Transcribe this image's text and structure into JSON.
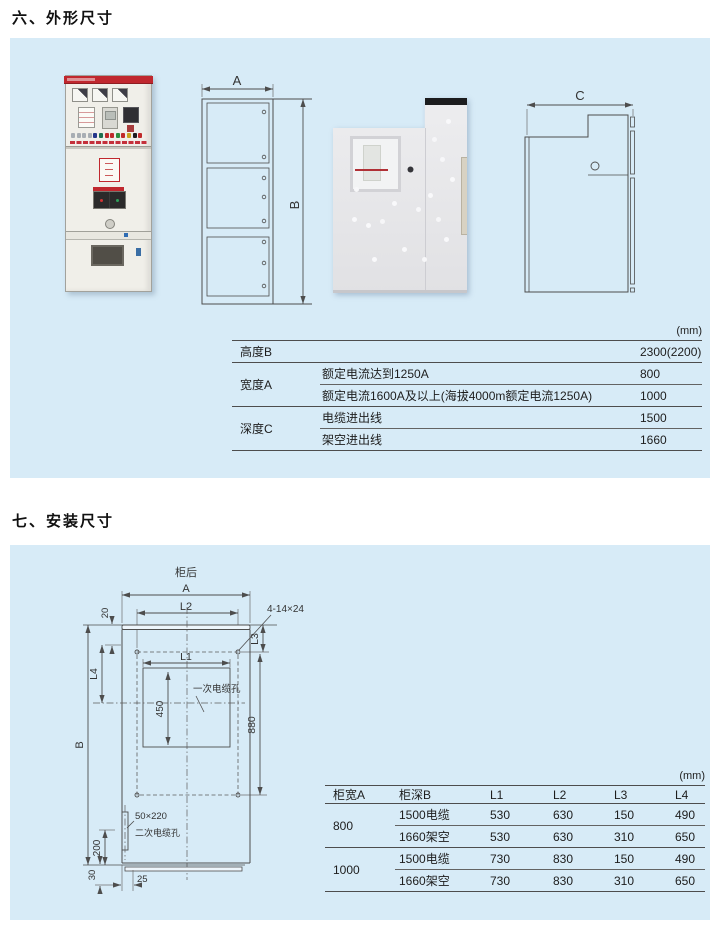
{
  "sections": {
    "outline_title": "六、外形尺寸",
    "install_title": "七、安装尺寸"
  },
  "colors": {
    "panel_bg": "#d7ebf7",
    "cabinet_red": "#c0272e",
    "drawing_line": "#4d4d4d"
  },
  "outline_view": {
    "front": {
      "width_label": "A",
      "height_label": "B"
    },
    "side": {
      "depth_label": "C"
    }
  },
  "outline_table": {
    "unit": "(mm)",
    "groups": [
      {
        "param": "高度B",
        "rows": [
          {
            "cond": "",
            "value": "2300(2200)"
          }
        ]
      },
      {
        "param": "宽度A",
        "rows": [
          {
            "cond": "额定电流达到1250A",
            "value": "800"
          },
          {
            "cond": "额定电流1600A及以上(海拔4000m额定电流1250A)",
            "value": "1000"
          }
        ]
      },
      {
        "param": "深度C",
        "rows": [
          {
            "cond": "电缆进出线",
            "value": "1500"
          },
          {
            "cond": "架空进出线",
            "value": "1660"
          }
        ]
      }
    ]
  },
  "install_drawing": {
    "back_label": "柜后",
    "labels": {
      "A": "A",
      "B": "B",
      "L1": "L1",
      "L2": "L2",
      "L3": "L3",
      "L4": "L4",
      "d20": "20",
      "d450": "450",
      "d880": "880",
      "d200": "200",
      "d30": "30",
      "d25": "25",
      "holes_note": "4-14×24",
      "primary_hole": "一次电缆孔",
      "slot_size": "50×220",
      "secondary_hole": "二次电缆孔"
    }
  },
  "install_table": {
    "unit": "(mm)",
    "headers": [
      "柜宽A",
      "柜深B",
      "L1",
      "L2",
      "L3",
      "L4"
    ],
    "groups": [
      {
        "width": "800",
        "rows": [
          {
            "depth": "1500电缆",
            "L1": "530",
            "L2": "630",
            "L3": "150",
            "L4": "490"
          },
          {
            "depth": "1660架空",
            "L1": "530",
            "L2": "630",
            "L3": "310",
            "L4": "650"
          }
        ]
      },
      {
        "width": "1000",
        "rows": [
          {
            "depth": "1500电缆",
            "L1": "730",
            "L2": "830",
            "L3": "150",
            "L4": "490"
          },
          {
            "depth": "1660架空",
            "L1": "730",
            "L2": "830",
            "L3": "310",
            "L4": "650"
          }
        ]
      }
    ]
  }
}
